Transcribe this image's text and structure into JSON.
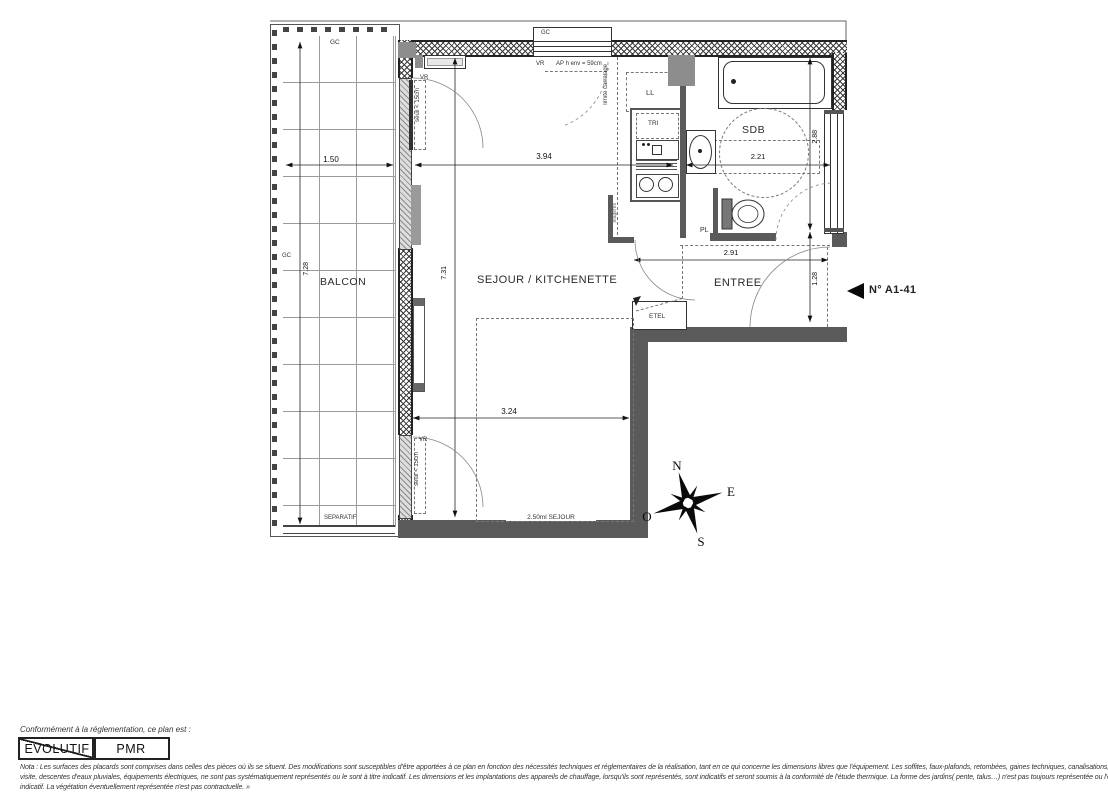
{
  "plan": {
    "unit": {
      "number": "N° A1-41"
    },
    "rooms": {
      "balcon": "BALCON",
      "sejour": "SEJOUR / KITCHENETTE",
      "sdb": "SDB",
      "entree": "ENTREE"
    },
    "annotations": {
      "gc_top": "GC",
      "gc_left": "GC",
      "gc_window": "GC",
      "vr_upper": "VR",
      "vr_window": "VR",
      "vr_lower": "VR",
      "seuil_upper": "seuil < 15cm",
      "seuil_lower": "seuil < 15cm",
      "ap_height": "AP h env = 59cm",
      "limite_carrelage": "limite carrelage",
      "ll": "LL",
      "tri": "TRI",
      "pl": "PL",
      "etel": "ETEL",
      "etageres": "étagères",
      "separatif": "SEPARATIF",
      "sejour_zone": "2.50ml SEJOUR"
    },
    "dimensions": {
      "balcony_width": "1.50",
      "balcony_depth": "7.28",
      "sejour_width": "3.94",
      "sdb_width": "2.21",
      "sejour_depth": "7.31",
      "sejour_lower_width": "3.24",
      "entree_width": "2.91",
      "sdb_depth": "2.88",
      "entree_depth": "1.28"
    },
    "compass": {
      "north": "N",
      "east": "E",
      "south": "S",
      "west": "O"
    }
  },
  "footer": {
    "heading": "Conformément à la réglementation, ce plan est :",
    "stamps": [
      {
        "label": "EVOLUTIF",
        "struck": true
      },
      {
        "label": "PMR",
        "struck": false
      }
    ],
    "nota": [
      "Nota : Les surfaces des placards sont comprises dans celles des pièces où ils se situent. Des modifications sont susceptibles d'être apportées à ce plan en fonction des nécessités techniques et réglementaires de la réalisation, tant en ce qui concerne les dimensions libres que l'équipement.  Les soffites, faux-plafonds, retombées, gaines techniques, canalisations, trappes de",
      "visite, descentes d'eaux pluviales, équipements électriques, ne sont pas systématiquement représentés ou le sont à titre indicatif. Les dimensions et les implantations des appareils de chauffage, lorsqu'ils sont représentés, sont indicatifs et seront soumis à la conformité de l'étude thermique. La forme des jardins( pente, talus…) n'est pas toujours représentée ou l'est à titre",
      "indicatif. La végétation éventuellement représentée n'est pas contractuelle. »"
    ]
  }
}
